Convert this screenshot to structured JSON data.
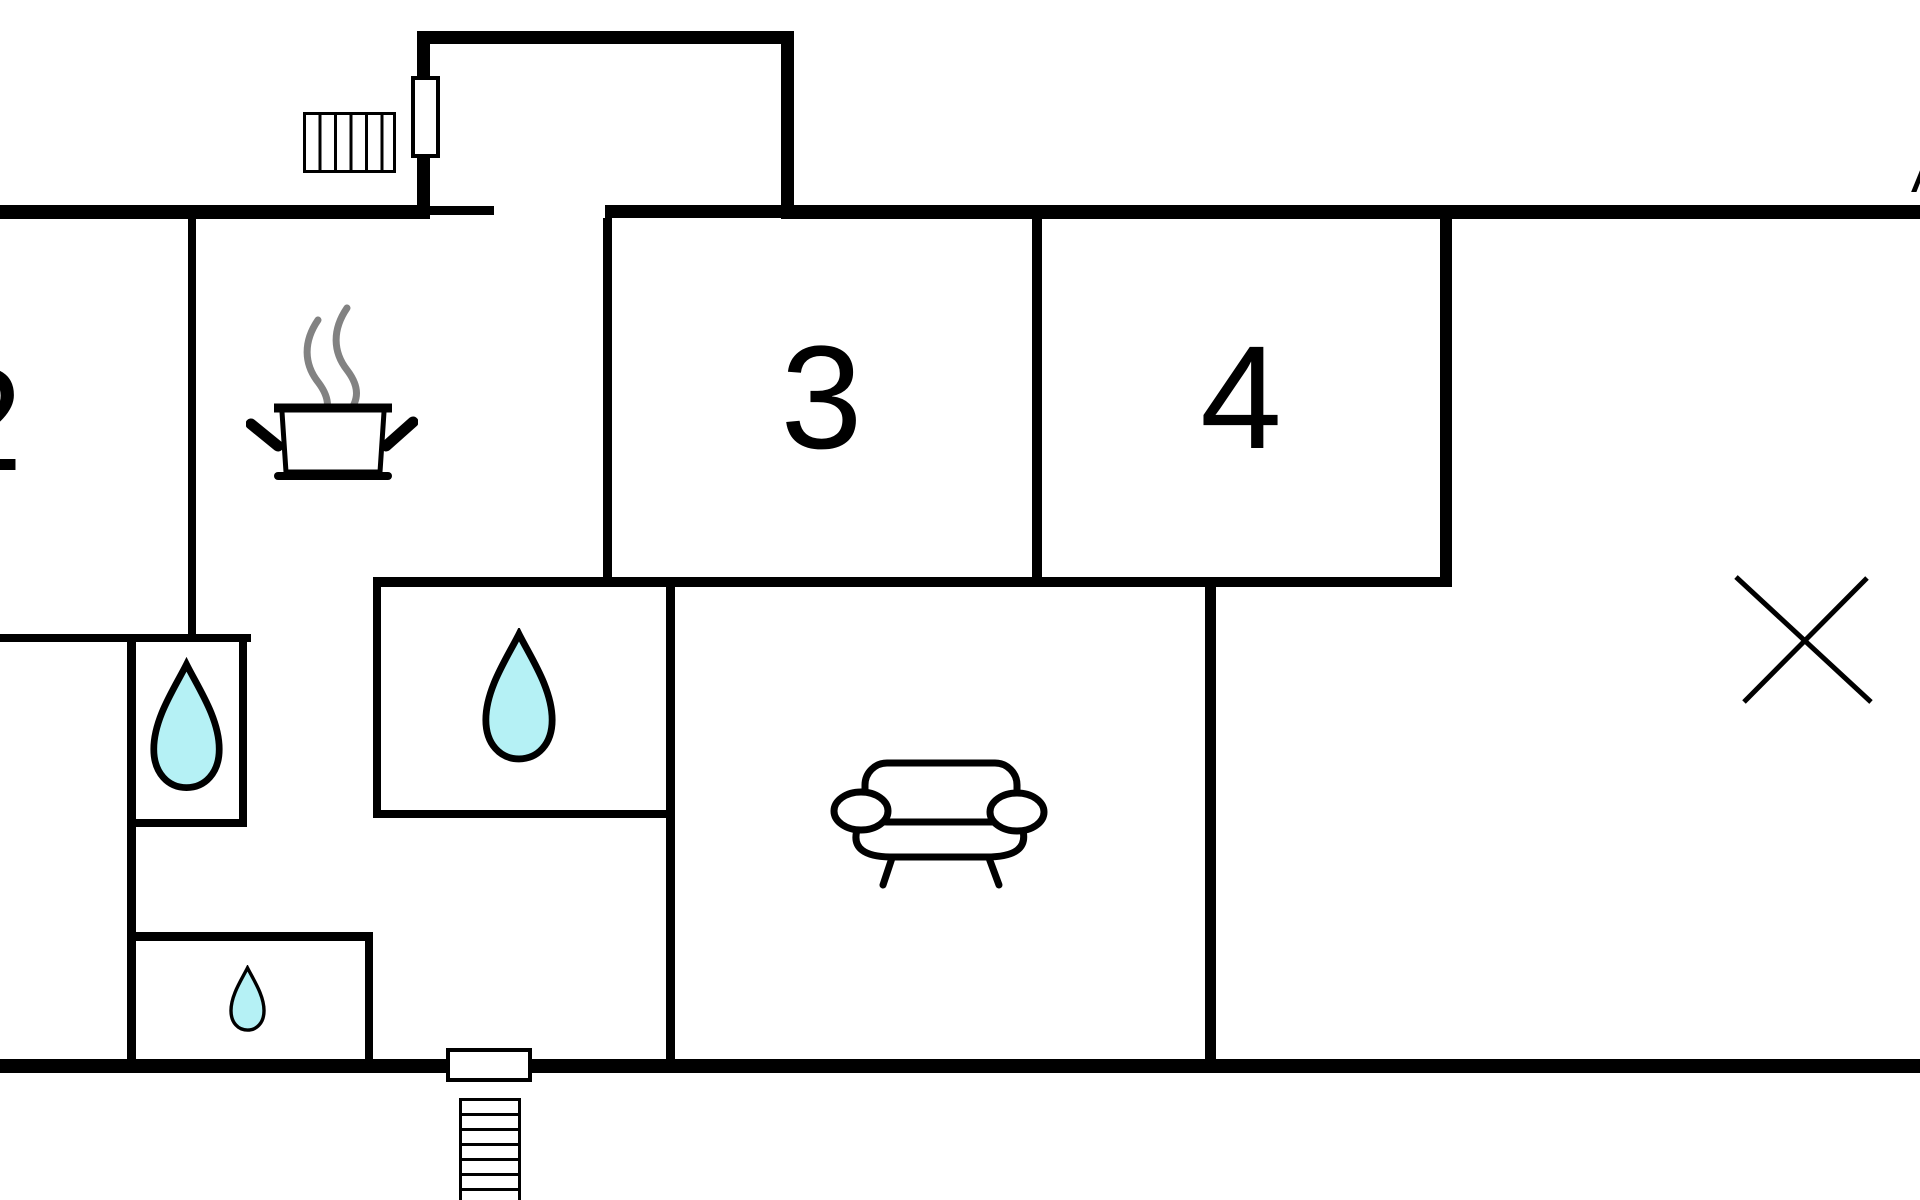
{
  "title": "apartment-floor-plan",
  "colors": {
    "wall": "#000000",
    "background": "#ffffff",
    "water_fill": "#b5f1f5",
    "steam": "#828282",
    "line": "#000000"
  },
  "rooms": {
    "room2": {
      "label": "2",
      "note": "partially cut off at left edge"
    },
    "room3": {
      "label": "3"
    },
    "room4": {
      "label": "4"
    },
    "kitchen": {
      "icon": "cooking-pot-icon"
    },
    "living_room": {
      "icon": "sofa-icon"
    },
    "bathroom_main": {
      "icon": "water-drop-icon"
    },
    "bathroom_left": {
      "icon": "water-drop-icon"
    },
    "wc_small": {
      "icon": "water-drop-icon"
    },
    "unmarked_room": {
      "icon": "x-mark-icon"
    }
  },
  "annotations": {
    "corner_letter": "A"
  },
  "entrances": {
    "top": {
      "symbols": [
        "door-rect",
        "steps"
      ],
      "step_count": 6
    },
    "bottom": {
      "symbols": [
        "door-rect",
        "steps"
      ],
      "step_count": 7
    }
  }
}
